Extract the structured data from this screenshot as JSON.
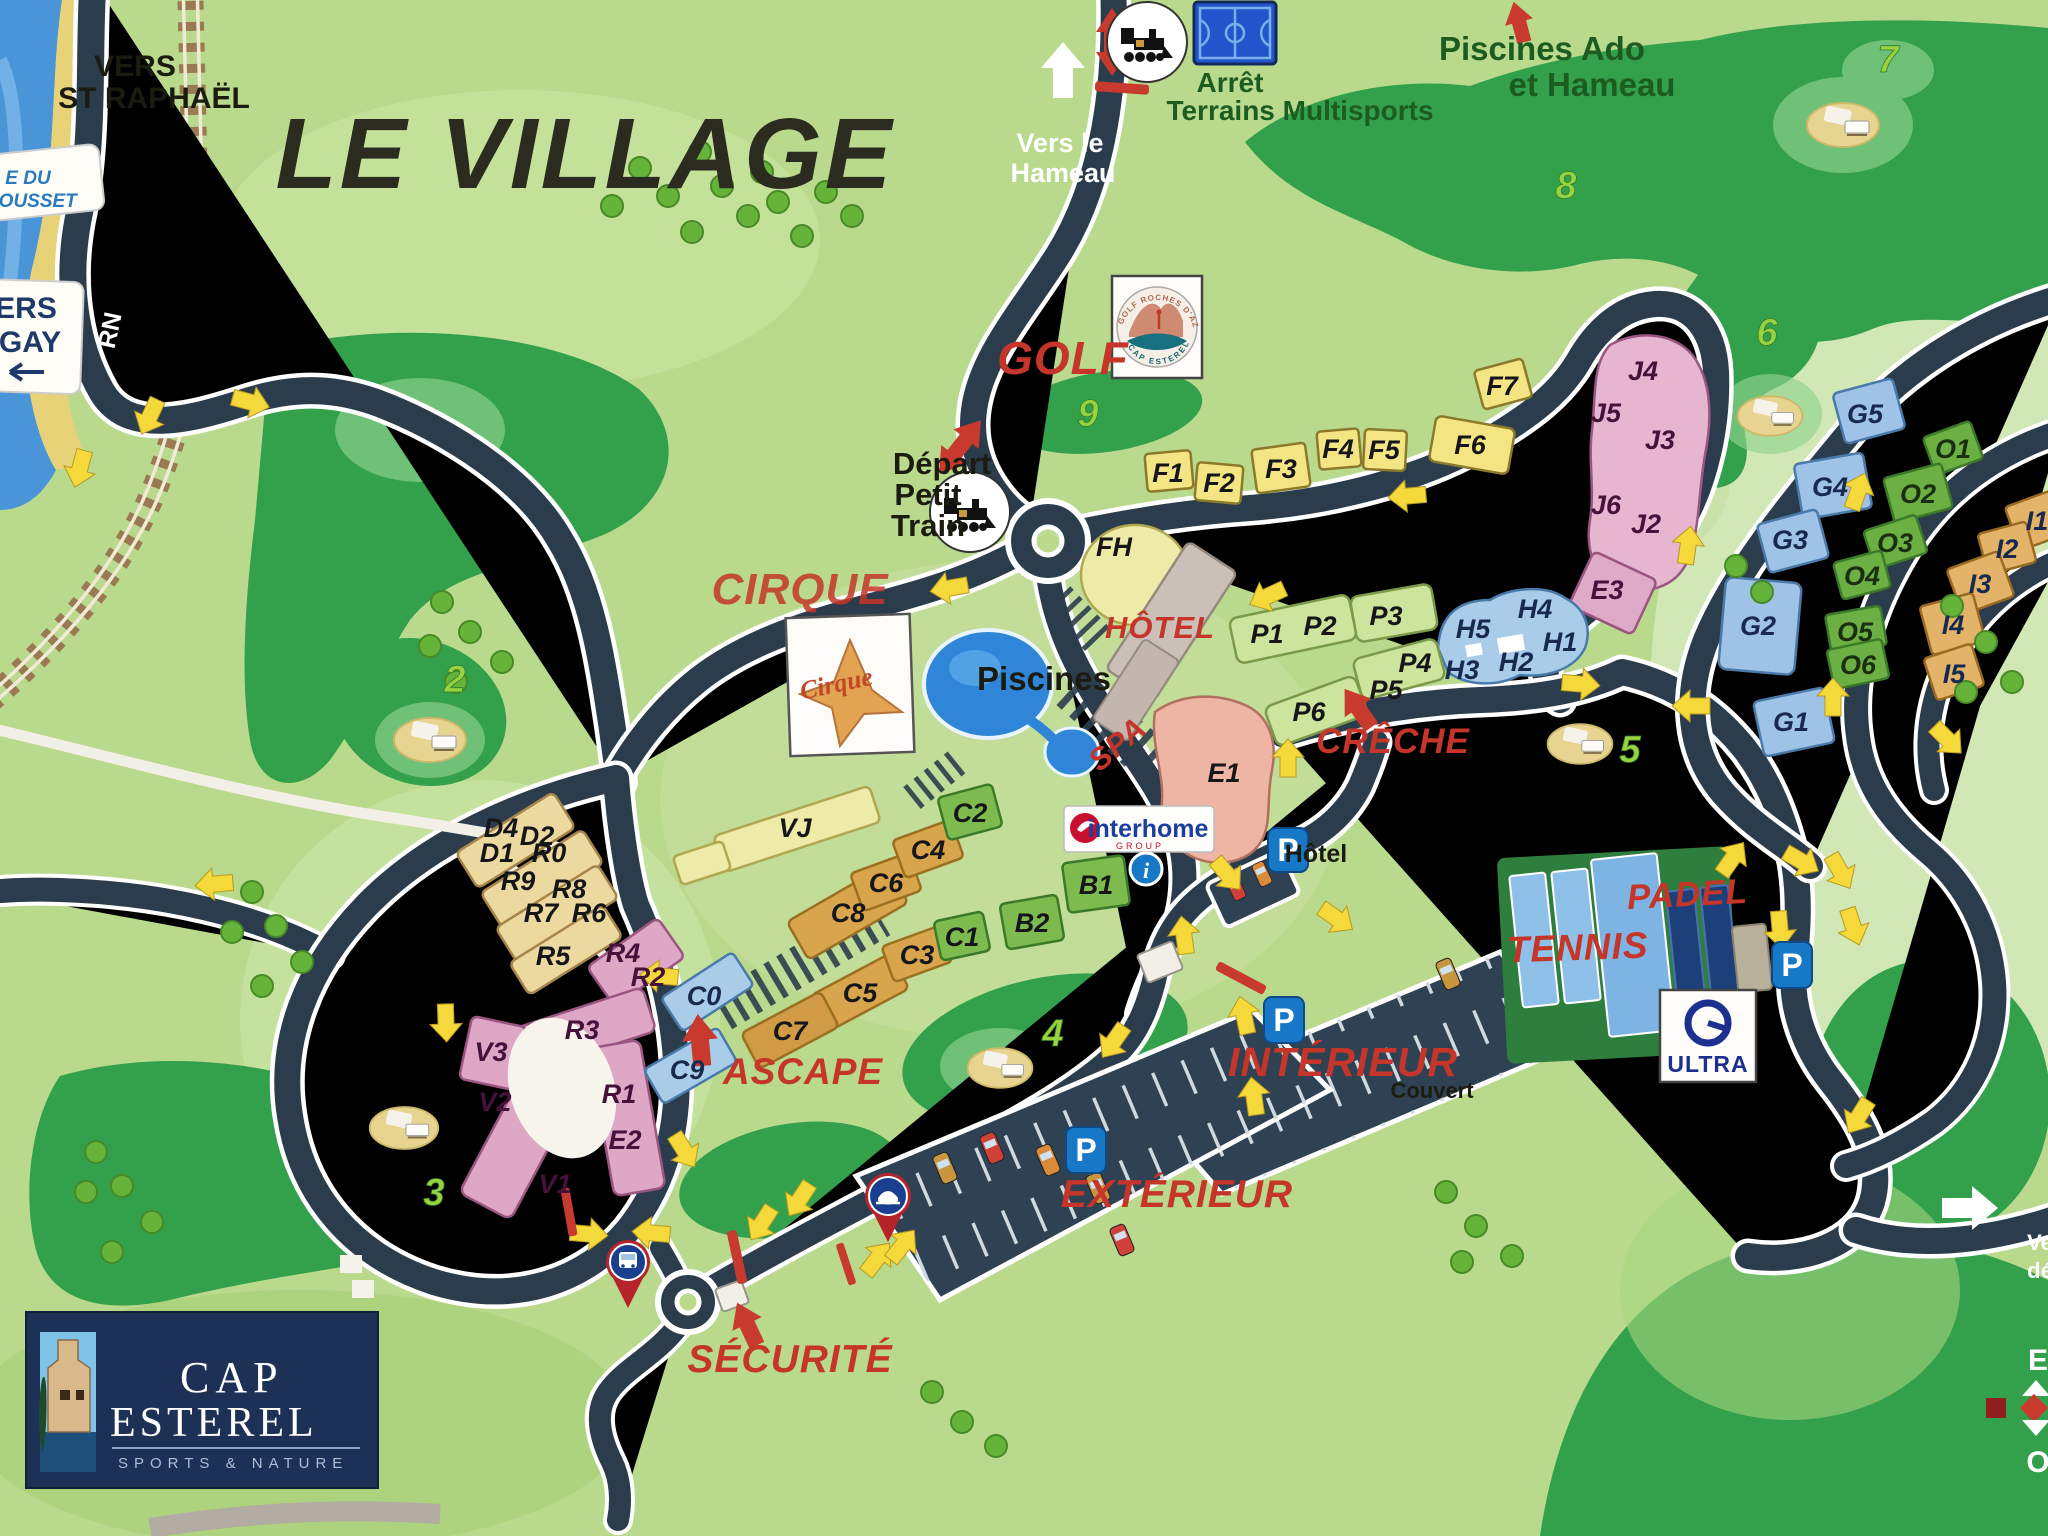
{
  "title": "LE VILLAGE",
  "signs": {
    "plage_1": "E DU",
    "plage_2": "RROUSSET",
    "agay_1": "ERS",
    "agay_2": "GAY",
    "rn": "RN",
    "st_raphael_1": "VERS",
    "st_raphael_2": "ST RAPHAËL",
    "hameau_1": "Vers le",
    "hameau_2": "Hameau",
    "arret_1": "Arrêt",
    "arret_2": "Terrains Multisports",
    "piscines_ado_1": "Piscines Ado",
    "piscines_ado_2": "et Hameau",
    "golf": "GOLF",
    "depart_1": "Départ",
    "depart_2": "Petit",
    "depart_3": "Train",
    "cirque": "CIRQUE",
    "hotel": "HÔTEL",
    "piscines": "Piscines",
    "spa": "SPA",
    "creche": "CRÊCHE",
    "ascape": "ASCAPE",
    "securite": "SÉCURITÉ",
    "interieur": "INTÉRIEUR",
    "couvert": "Couvert",
    "exterieur": "EXTÉRIEUR",
    "tennis": "TENNIS",
    "padel": "PADEL",
    "parking_hotel": "Hôtel",
    "vers_exit_1": "Ve",
    "vers_exit_2": "dé",
    "compass_e": "E",
    "compass_o": "O"
  },
  "icons": {
    "p": "P",
    "info": "i"
  },
  "logos": {
    "interhome": "interhome",
    "interhome_sub": "GROUP",
    "ultra": "ULTRA",
    "cap_1": "CAP",
    "cap_2": "ESTEREL",
    "cap_3": "SPORTS & NATURE",
    "golf_arc_top": "GOLF ROCHES D'AZUR",
    "golf_arc_bottom": "CAP ESTEREL",
    "cirque_script": "Cirque"
  },
  "golf_holes": [
    "2",
    "3",
    "4",
    "5",
    "6",
    "7",
    "8",
    "9"
  ],
  "buildings": {
    "f": [
      "F1",
      "F2",
      "F3",
      "F4",
      "F5",
      "F6",
      "F7"
    ],
    "fh": "FH",
    "j": [
      "J4",
      "J5",
      "J3",
      "J6",
      "J2"
    ],
    "h": [
      "H5",
      "H4",
      "H1",
      "H3",
      "H2"
    ],
    "e": [
      "E1",
      "E2",
      "E3"
    ],
    "p": [
      "P1",
      "P2",
      "P3",
      "P4",
      "P5",
      "P6"
    ],
    "g": [
      "G5",
      "G4",
      "G3",
      "G2",
      "G1"
    ],
    "o": [
      "O1",
      "O2",
      "O3",
      "O4",
      "O5",
      "O6"
    ],
    "i": [
      "I1",
      "I2",
      "I3",
      "I4",
      "I5"
    ],
    "d": [
      "D4",
      "D2",
      "D1"
    ],
    "r_tan": [
      "R0",
      "R9",
      "R8",
      "R7",
      "R6",
      "R5"
    ],
    "r_pink": [
      "R4",
      "R2",
      "R3",
      "R1"
    ],
    "v": [
      "V3",
      "V2",
      "V1"
    ],
    "vj": "VJ",
    "c_blue": [
      "C0",
      "C9"
    ],
    "c_orange": [
      "C8",
      "C3",
      "C5",
      "C7",
      "C6",
      "C4"
    ],
    "c_green": [
      "C2",
      "C1"
    ],
    "b": [
      "B1",
      "B2"
    ]
  },
  "colors": {
    "road": "#2b3d4d",
    "golf_green": "#33a04b",
    "accent_red": "#c83a2e",
    "arrow_yellow": "#f5d83a"
  }
}
